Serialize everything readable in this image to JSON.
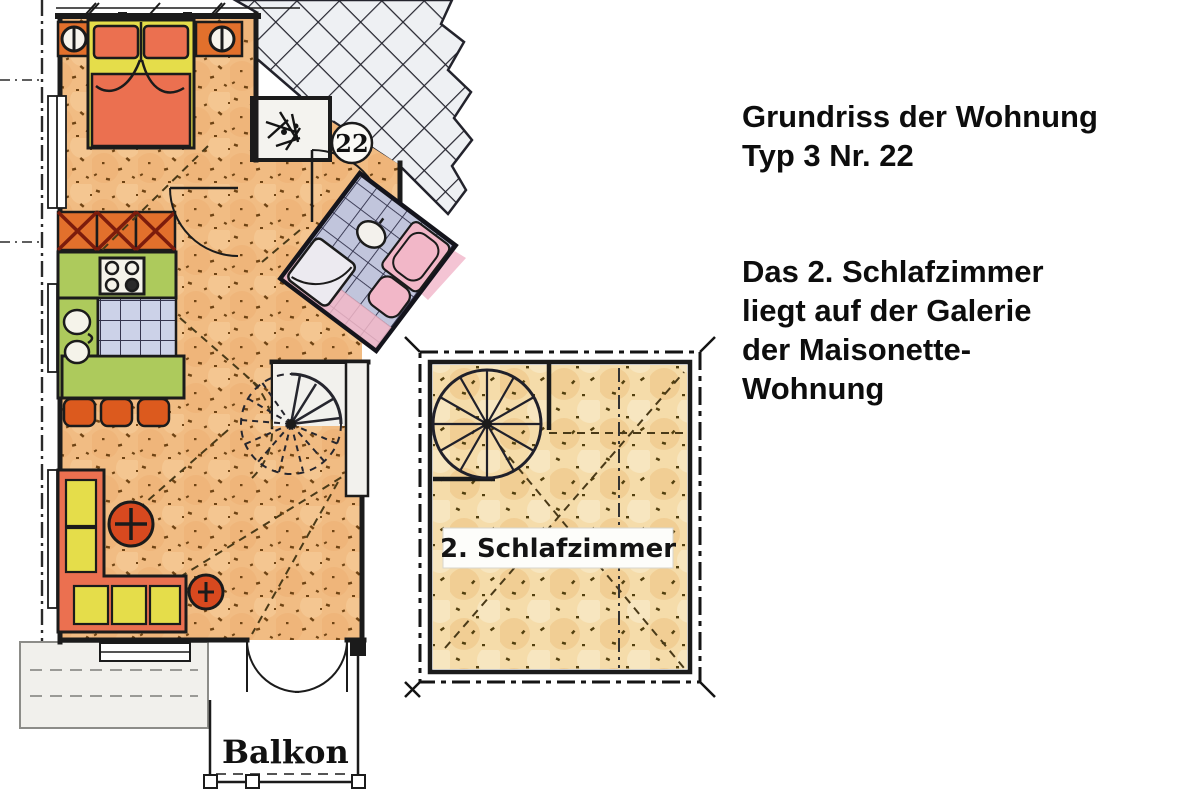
{
  "annotation": {
    "heading": "Grundriss der Wohnung\nTyp 3 Nr. 22",
    "body": "Das 2. Schlafzimmer\nliegt auf der Galerie\nder Maisonette-\nWohnung"
  },
  "main_plan": {
    "unit_number": "22",
    "balcony_label": "Balkon"
  },
  "gallery_plan": {
    "label": "2. Schlafzimmer"
  },
  "palette": {
    "floor_main": "#f1bc83",
    "floor_gallery": "#f5dcaa",
    "corridor_tile": "#eef0f3",
    "bath_tile": "#c1c5dc",
    "kitchen_tile": "#ccd2e8",
    "kitchen_green": "#adca5c",
    "sofa_red": "#eb7050",
    "cushion_yellow": "#e5dd4a",
    "wardrobe_orange": "#e2702c",
    "chair_orange": "#dc5a1e",
    "table_red": "#d8491f",
    "fixture_pink": "#f2b7c8",
    "wall": "#1b1b1b"
  }
}
